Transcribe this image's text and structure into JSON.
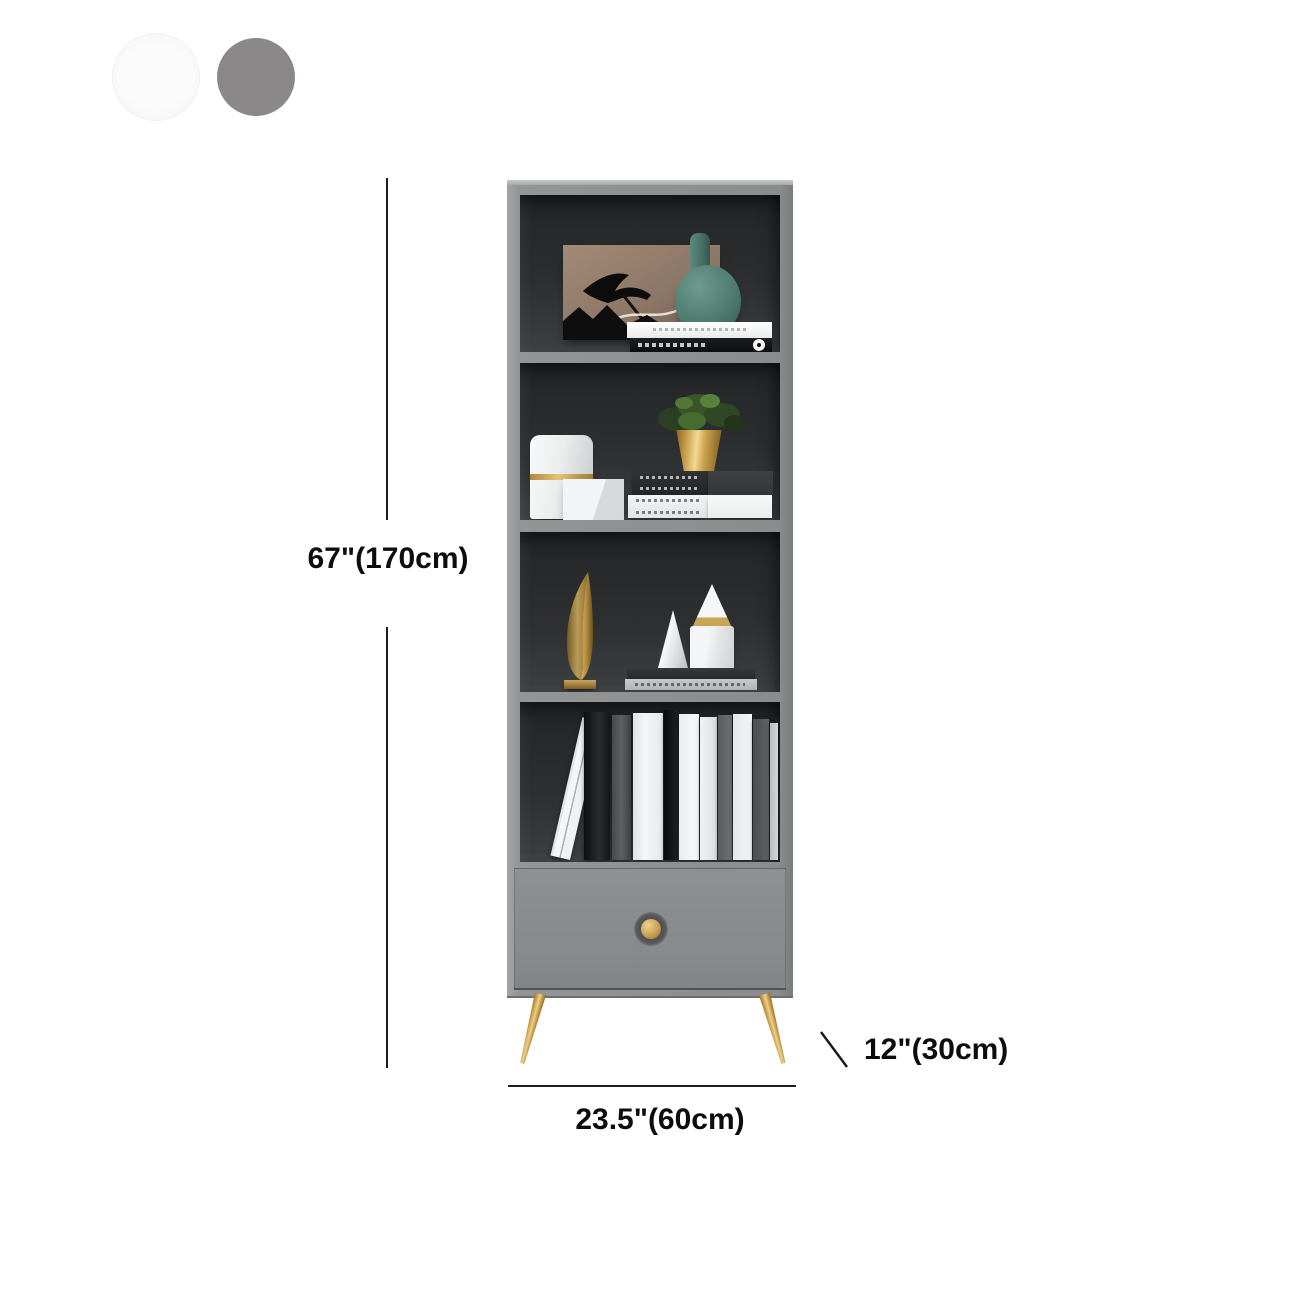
{
  "title": "bookcase-dimension-diagram",
  "swatches": {
    "white": {
      "label": "white finish option",
      "color": "#fbfbfb"
    },
    "gray": {
      "label": "gray finish option",
      "color": "#8a8889"
    }
  },
  "dimensions": {
    "height": "67\"(170cm)",
    "width": "23.5\"(60cm)",
    "depth": "12\"(30cm)",
    "line_color": "#1c1c1c",
    "text_color": "#0d0d0d"
  },
  "bookcase": {
    "frame_color": "#8e9092",
    "interior_color": "#2d2f31",
    "drawer_color": "#87898a",
    "gold_color": "#c7a156",
    "teal_color": "#4e7a70",
    "shelf_items": [
      "artwork-panel, teal-vase, stacked-books",
      "white-canister, white-cube, gold-potted-plant, stacked-books",
      "gold-sculpture, white-cone, marble-cone, marble-cylinder, stacked-books",
      "row-of-standing-books"
    ],
    "shelf4_books": [
      {
        "left": 30,
        "w": 20,
        "h": 142,
        "lean": 13,
        "color": "linear-gradient(90deg,#e3e4e6 0 12%,#f4f5f6 12% 45%,#a9abad 45% 52%,#f0f1f2 52% 100%)"
      },
      {
        "left": 64,
        "w": 26,
        "h": 148,
        "color": "linear-gradient(90deg,#0e0f10,#2a2c2d 60%,#151617)"
      },
      {
        "left": 92,
        "w": 19,
        "h": 145,
        "color": "linear-gradient(90deg,#46494b,#5d6062 50%,#3f4244)"
      },
      {
        "left": 113,
        "w": 30,
        "h": 147,
        "color": "linear-gradient(90deg,#dfe1e2,#f5f6f7 40%,#e8e9ea)"
      },
      {
        "left": 144,
        "w": 14,
        "h": 150,
        "color": "linear-gradient(90deg,#0a0b0c,#1f2122)"
      },
      {
        "left": 159,
        "w": 20,
        "h": 146,
        "color": "linear-gradient(90deg,#ecedee,#f8f9fa)"
      },
      {
        "left": 180,
        "w": 17,
        "h": 143,
        "color": "linear-gradient(90deg,#f0f1f2,#dcdee0)"
      },
      {
        "left": 198,
        "w": 14,
        "h": 145,
        "color": "linear-gradient(90deg,#595c5e,#6f7274)"
      },
      {
        "left": 213,
        "w": 19,
        "h": 146,
        "color": "linear-gradient(90deg,#e6e7e9,#f3f4f5)"
      },
      {
        "left": 233,
        "w": 16,
        "h": 141,
        "color": "linear-gradient(90deg,#4a4d4f,#606365)"
      },
      {
        "left": 250,
        "w": 8,
        "h": 137,
        "color": "linear-gradient(90deg,#babcbe,#d3d5d7)"
      }
    ]
  }
}
